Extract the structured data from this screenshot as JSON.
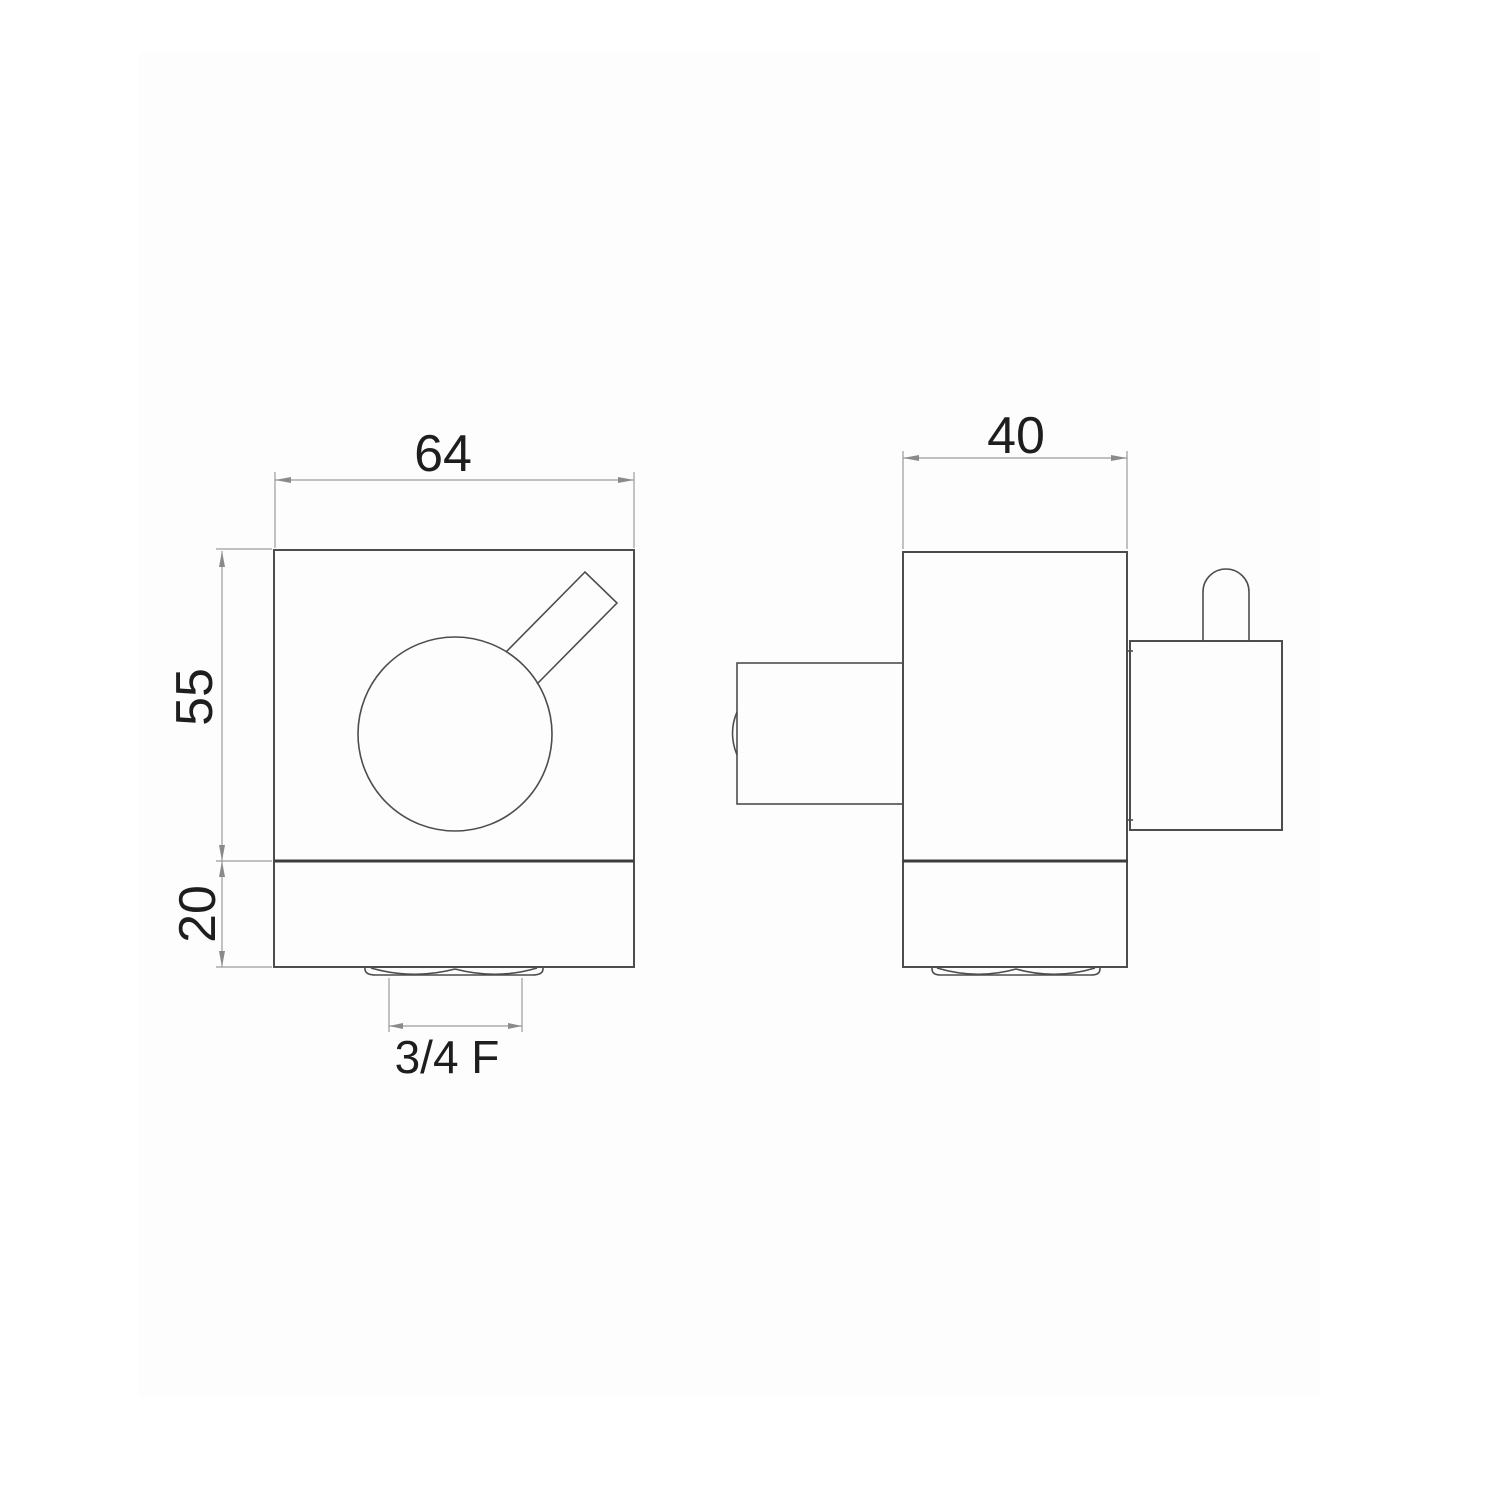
{
  "colors": {
    "background": "#ffffff",
    "inset_background": "#fdfdfd",
    "object_line": "#4d4d4d",
    "dimension_line": "#9b9b9b",
    "text": "#1e1e1e"
  },
  "drawing": {
    "kind": "valve-technical-drawing",
    "front_view": {
      "width_label": "64",
      "upper_height_label": "55",
      "lower_height_label": "20",
      "outlet_thread_label": "3/4 F"
    },
    "side_view": {
      "depth_label": "40"
    }
  }
}
